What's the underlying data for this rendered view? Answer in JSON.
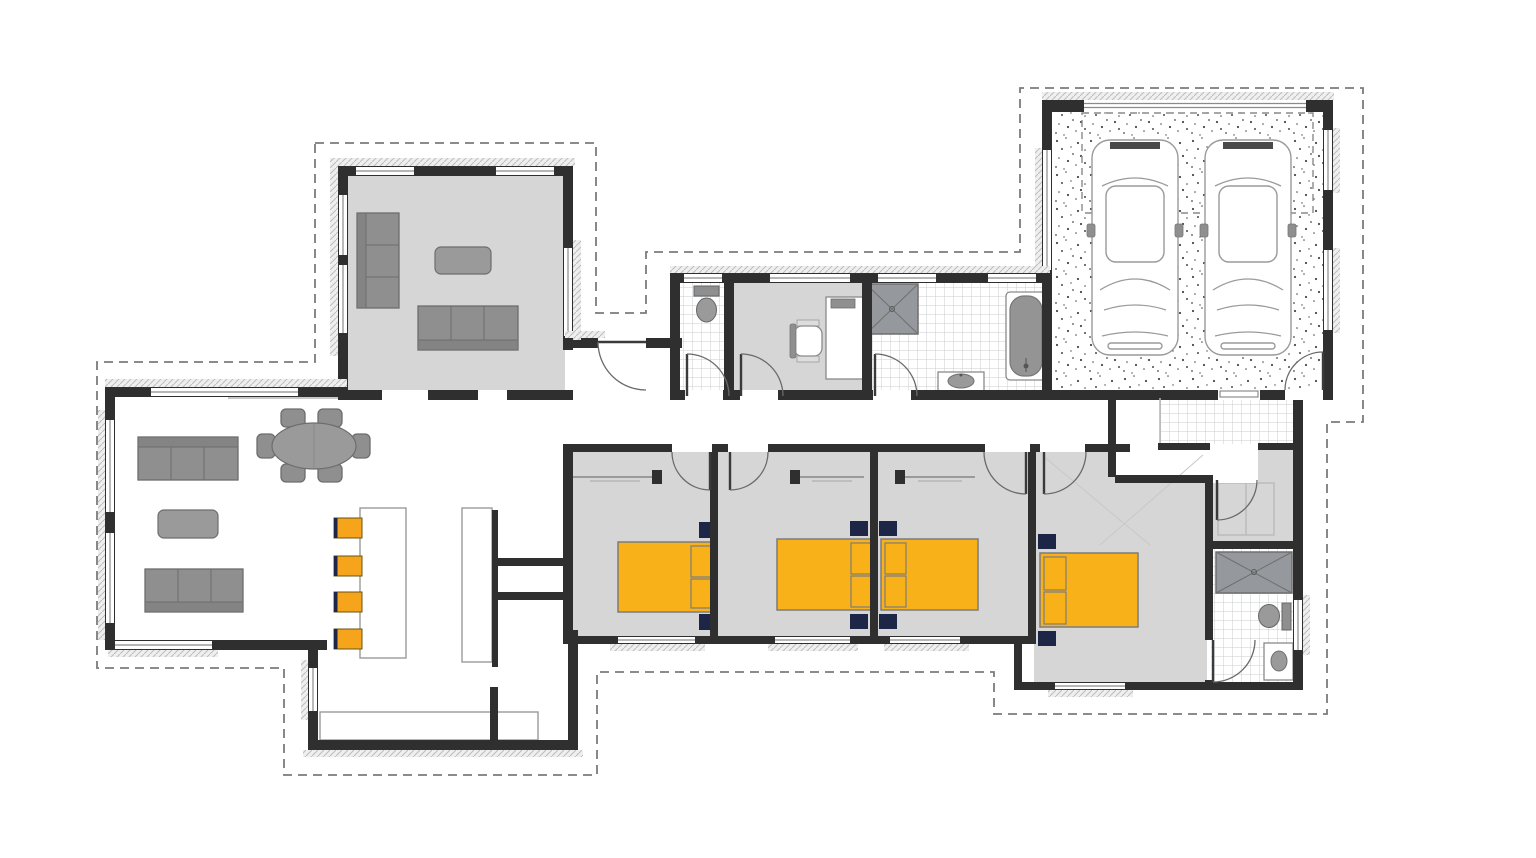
{
  "page": {
    "title": "residential-house-floor-plan",
    "background": "#ffffff"
  },
  "colors": {
    "white": "#ffffff",
    "wall": "#2f2f2f",
    "floor_grey": "#d6d6d6",
    "tile_line": "#c8cdd1",
    "stipple_dot": "#4a4a4a",
    "furniture": "#8f8f8f",
    "furniture_dark": "#6d6d6d",
    "table_grey": "#9a9a9a",
    "bed_yellow": "#f8b119",
    "bed_outline": "#7c7c7c",
    "navy": "#1d2647",
    "stool_orange": "#f6a41b",
    "window_line": "#8a8a8a",
    "dash": "#7b7b7b",
    "shower": "#95999d",
    "hatch": "#bdbdbd",
    "line_light": "#b5b5b5"
  },
  "plan": {
    "rooms": [
      {
        "id": "lounge",
        "floor": "grey",
        "furniture": [
          "sofa-3-seat-vertical",
          "coffee-table",
          "sofa-3-seat-horizontal"
        ]
      },
      {
        "id": "living-dining-kitchen",
        "floor": "white",
        "furniture": [
          "sofa-3-seat",
          "sofa-3-seat",
          "coffee-table",
          "oval-dining-table",
          "6-dining-chairs",
          "kitchen-island",
          "4-bar-stools",
          "kitchen-benches"
        ]
      },
      {
        "id": "rear-foyer",
        "floor": "white",
        "furniture": []
      },
      {
        "id": "wc",
        "floor": "tiles",
        "furniture": [
          "toilet"
        ]
      },
      {
        "id": "study",
        "floor": "grey",
        "furniture": [
          "desk",
          "office-chair"
        ]
      },
      {
        "id": "bathroom",
        "floor": "tiles",
        "furniture": [
          "shower",
          "vanity-basin",
          "bathtub"
        ]
      },
      {
        "id": "garage-double",
        "floor": "stipple-concrete",
        "furniture": [
          "car",
          "car"
        ]
      },
      {
        "id": "entry",
        "floor": "tiles",
        "furniture": []
      },
      {
        "id": "bedroom-2",
        "floor": "grey",
        "furniture": [
          "double-bed",
          "2-bedside-tables",
          "wardrobe"
        ]
      },
      {
        "id": "bedroom-3",
        "floor": "grey",
        "furniture": [
          "double-bed",
          "2-bedside-tables",
          "wardrobe"
        ]
      },
      {
        "id": "bedroom-4",
        "floor": "grey",
        "furniture": [
          "double-bed",
          "2-bedside-tables",
          "wardrobe"
        ]
      },
      {
        "id": "master-bedroom",
        "floor": "grey",
        "furniture": [
          "double-bed",
          "2-bedside-tables"
        ]
      },
      {
        "id": "walk-in-robe",
        "floor": "grey",
        "furniture": [
          "shelving"
        ]
      },
      {
        "id": "ensuite",
        "floor": "tiles",
        "furniture": [
          "shower",
          "toilet",
          "vanity-basin"
        ]
      },
      {
        "id": "scullery-kitchen-rear",
        "floor": "white",
        "furniture": [
          "bench-counter"
        ]
      }
    ],
    "counts": {
      "beds": 4,
      "sofas": 4,
      "cars": 2,
      "bar_stools": 4,
      "dining_chairs": 6,
      "toilets": 2,
      "showers": 2,
      "bathtubs": 1,
      "basins": 2,
      "coffee_tables": 2
    },
    "features": [
      "dashed-eaves-outline",
      "dashed-garage-door-opening",
      "window-sill-hatching",
      "door-swing-arcs",
      "stippled-garage-slab",
      "tiled-wet-areas"
    ]
  }
}
